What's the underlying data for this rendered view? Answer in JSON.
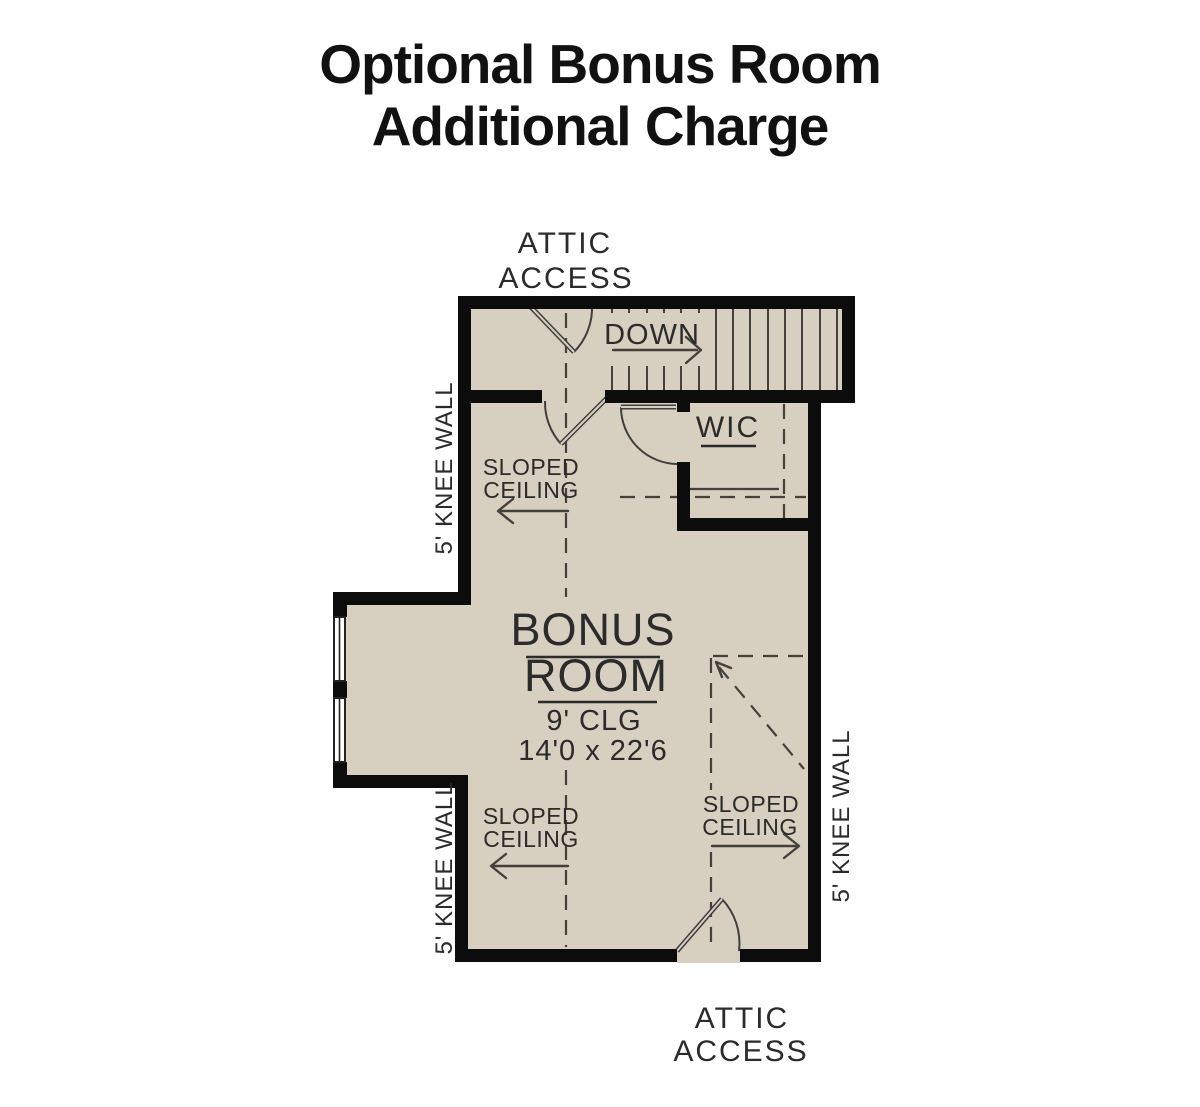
{
  "title": {
    "line1": "Optional Bonus Room",
    "line2": "Additional Charge"
  },
  "plan": {
    "attic_access_top": {
      "line1": "ATTIC",
      "line2": "ACCESS"
    },
    "attic_access_bottom": {
      "line1": "ATTIC",
      "line2": "ACCESS"
    },
    "stairs": {
      "direction_label": "DOWN"
    },
    "wic": {
      "label": "WIC"
    },
    "bonus_room": {
      "name_line1": "BONUS",
      "name_line2": "ROOM",
      "ceiling_height": "9' CLG",
      "dimensions": "14'0 x 22'6"
    },
    "sloped_ceiling_upper_left": {
      "line1": "SLOPED",
      "line2": "CEILING"
    },
    "sloped_ceiling_lower_left": {
      "line1": "SLOPED",
      "line2": "CEILING"
    },
    "sloped_ceiling_lower_right": {
      "line1": "SLOPED",
      "line2": "CEILING"
    },
    "knee_wall_upper_left": "5' KNEE WALL",
    "knee_wall_lower_left": "5' KNEE WALL",
    "knee_wall_right": "5' KNEE WALL"
  },
  "colors": {
    "floor": "#d7cfbf",
    "wall": "#0c0c0c",
    "line": "#43413c",
    "door": "#3f3f3f",
    "text": "#2b2b2b",
    "title": "#111111",
    "background": "#ffffff"
  }
}
